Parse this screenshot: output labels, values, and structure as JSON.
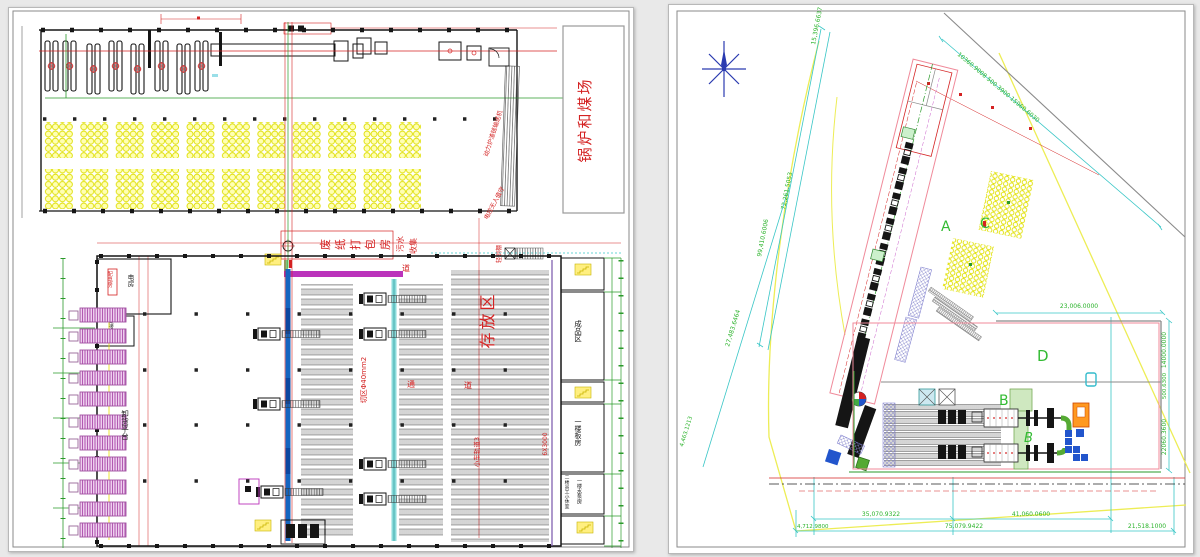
{
  "left": {
    "side_label": "锅炉和煤场",
    "packing_room": "废纸打包房",
    "sewage_l1": "污水",
    "sewage_l2": "收集",
    "storage_area": "存放区",
    "cut_zone": "切区Φ40mm2",
    "cart_track": "小车轨道3",
    "word_tong": "通",
    "word_dao": "道",
    "word_dao2": "道",
    "steel_shed": "轻钢棚",
    "slag_conveyor": "动力炉渣链输送机",
    "unattended": "电控无人值守",
    "unload_platform": "卸货平台",
    "power_room": "配电房",
    "electric_room": "电房",
    "shift_room": "交接班室",
    "finished_area": "成品区",
    "floor_room": "一楼板房",
    "rest_room": "二楼员工小休室",
    "pump_room": "一楼水泵房",
    "dim_note": "6X3000"
  },
  "right": {
    "area_a": "A",
    "area_b": "B",
    "area_b2": "B",
    "area_c": "C",
    "area_d": "D",
    "dim_left_top": "15,396.6637",
    "dim_left_mid": "72,261.5053",
    "dim_left_low": "99,410.6006",
    "dim_top": "10360.9008  500.3900  15960.6030",
    "dim_ne": "23,006.0000",
    "dim_e1": "14000.0000",
    "dim_e2": "500.6300",
    "dim_e3": "22060.3600",
    "dim_sw1": "27,483.6464",
    "dim_sw2": "4,463.1213",
    "dim_s1": "35,070.9322",
    "dim_s2": "41,060.0600",
    "dim_s3": "4,712.9800",
    "dim_s4": "75,079.9422",
    "dim_s5": "21,518.1000"
  }
}
